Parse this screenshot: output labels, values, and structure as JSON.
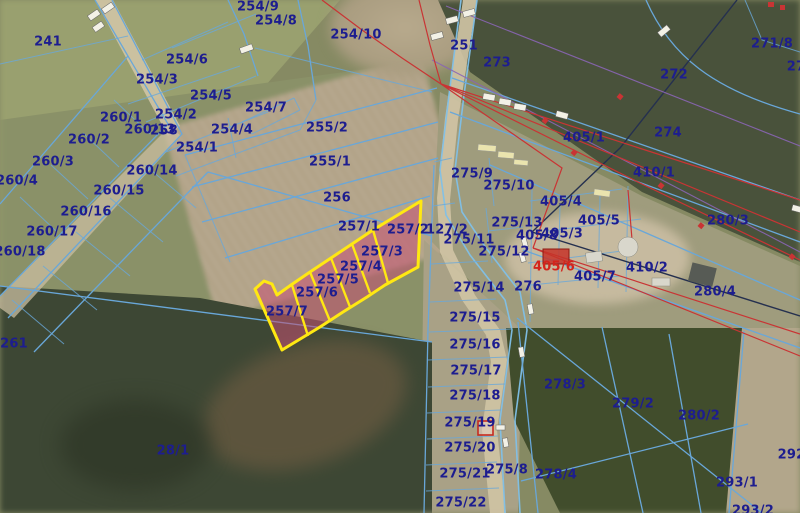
{
  "map": {
    "type": "cadastral-parcel-map-over-aerial-photo",
    "highlighted_parcels": [
      "257/2",
      "257/3",
      "257/4",
      "257/5",
      "257/6",
      "257/7"
    ],
    "colors": {
      "parcelLine": "#69a7d9",
      "roadLine": "#7fc0e8",
      "labelNavy": "#1d1d8f",
      "labelRed": "#d3241c",
      "powerLine": "#c93434",
      "purpleLine": "#8a65b5",
      "darkLine": "#25304f",
      "highlight": "#ffe812",
      "highlightFill": "rgba(196,80,115,0.55)"
    },
    "labels": [
      {
        "t": "241",
        "x": 48,
        "y": 42
      },
      {
        "t": "254/9",
        "x": 258,
        "y": 7
      },
      {
        "t": "254/8",
        "x": 276,
        "y": 21
      },
      {
        "t": "254/10",
        "x": 356,
        "y": 35
      },
      {
        "t": "251",
        "x": 464,
        "y": 46
      },
      {
        "t": "273",
        "x": 497,
        "y": 63
      },
      {
        "t": "271/8",
        "x": 772,
        "y": 44
      },
      {
        "t": "27",
        "x": 796,
        "y": 67
      },
      {
        "t": "272",
        "x": 674,
        "y": 75
      },
      {
        "t": "254/6",
        "x": 187,
        "y": 60
      },
      {
        "t": "254/3",
        "x": 157,
        "y": 80
      },
      {
        "t": "254/5",
        "x": 211,
        "y": 96
      },
      {
        "t": "254/2",
        "x": 176,
        "y": 115
      },
      {
        "t": "260/1",
        "x": 121,
        "y": 118
      },
      {
        "t": "260/13",
        "x": 150,
        "y": 130
      },
      {
        "t": "258",
        "x": 164,
        "y": 131
      },
      {
        "t": "254/4",
        "x": 232,
        "y": 130
      },
      {
        "t": "254/7",
        "x": 266,
        "y": 108
      },
      {
        "t": "255/2",
        "x": 327,
        "y": 128
      },
      {
        "t": "254/1",
        "x": 197,
        "y": 148
      },
      {
        "t": "260/2",
        "x": 89,
        "y": 140
      },
      {
        "t": "260/3",
        "x": 53,
        "y": 162
      },
      {
        "t": "260/4",
        "x": 17,
        "y": 181
      },
      {
        "t": "260/14",
        "x": 152,
        "y": 171
      },
      {
        "t": "260/15",
        "x": 119,
        "y": 191
      },
      {
        "t": "255/1",
        "x": 330,
        "y": 162
      },
      {
        "t": "260/16",
        "x": 86,
        "y": 212
      },
      {
        "t": "256",
        "x": 337,
        "y": 198
      },
      {
        "t": "260/17",
        "x": 52,
        "y": 232
      },
      {
        "t": "257/1",
        "x": 359,
        "y": 227
      },
      {
        "t": "257/2",
        "x": 408,
        "y": 230
      },
      {
        "t": "127/2",
        "x": 447,
        "y": 230
      },
      {
        "t": "260/18",
        "x": 20,
        "y": 252
      },
      {
        "t": "275/9",
        "x": 472,
        "y": 174
      },
      {
        "t": "275/10",
        "x": 509,
        "y": 186
      },
      {
        "t": "405/1",
        "x": 584,
        "y": 138
      },
      {
        "t": "410/1",
        "x": 654,
        "y": 173
      },
      {
        "t": "274",
        "x": 668,
        "y": 133
      },
      {
        "t": "280/3",
        "x": 728,
        "y": 221
      },
      {
        "t": "405/4",
        "x": 561,
        "y": 202
      },
      {
        "t": "405/5",
        "x": 599,
        "y": 221
      },
      {
        "t": "275/13",
        "x": 517,
        "y": 223
      },
      {
        "t": "405/8",
        "x": 537,
        "y": 236
      },
      {
        "t": "405/3",
        "x": 562,
        "y": 234
      },
      {
        "t": "275/11",
        "x": 469,
        "y": 240
      },
      {
        "t": "275/12",
        "x": 504,
        "y": 252
      },
      {
        "t": "405/6",
        "x": 554,
        "y": 267,
        "c": "red"
      },
      {
        "t": "410/2",
        "x": 647,
        "y": 268
      },
      {
        "t": "405/7",
        "x": 595,
        "y": 277
      },
      {
        "t": "275/14",
        "x": 479,
        "y": 288
      },
      {
        "t": "276",
        "x": 528,
        "y": 287
      },
      {
        "t": "280/4",
        "x": 715,
        "y": 292
      },
      {
        "t": "275/15",
        "x": 475,
        "y": 318
      },
      {
        "t": "257/3",
        "x": 382,
        "y": 252
      },
      {
        "t": "257/4",
        "x": 361,
        "y": 267
      },
      {
        "t": "257/5",
        "x": 338,
        "y": 280
      },
      {
        "t": "257/6",
        "x": 317,
        "y": 293
      },
      {
        "t": "257/7",
        "x": 287,
        "y": 312
      },
      {
        "t": "261",
        "x": 14,
        "y": 344
      },
      {
        "t": "275/16",
        "x": 475,
        "y": 345
      },
      {
        "t": "275/17",
        "x": 476,
        "y": 371
      },
      {
        "t": "275/18",
        "x": 475,
        "y": 396
      },
      {
        "t": "275/19",
        "x": 470,
        "y": 423
      },
      {
        "t": "275/20",
        "x": 470,
        "y": 448
      },
      {
        "t": "275/21",
        "x": 465,
        "y": 474
      },
      {
        "t": "275/8",
        "x": 507,
        "y": 470
      },
      {
        "t": "275/22",
        "x": 461,
        "y": 503
      },
      {
        "t": "278/3",
        "x": 565,
        "y": 385
      },
      {
        "t": "278/4",
        "x": 556,
        "y": 475
      },
      {
        "t": "279/2",
        "x": 633,
        "y": 404
      },
      {
        "t": "280/2",
        "x": 699,
        "y": 416
      },
      {
        "t": "292/",
        "x": 794,
        "y": 455
      },
      {
        "t": "293/1",
        "x": 737,
        "y": 483
      },
      {
        "t": "293/2",
        "x": 753,
        "y": 511
      },
      {
        "t": "28/1",
        "x": 173,
        "y": 451
      }
    ]
  }
}
